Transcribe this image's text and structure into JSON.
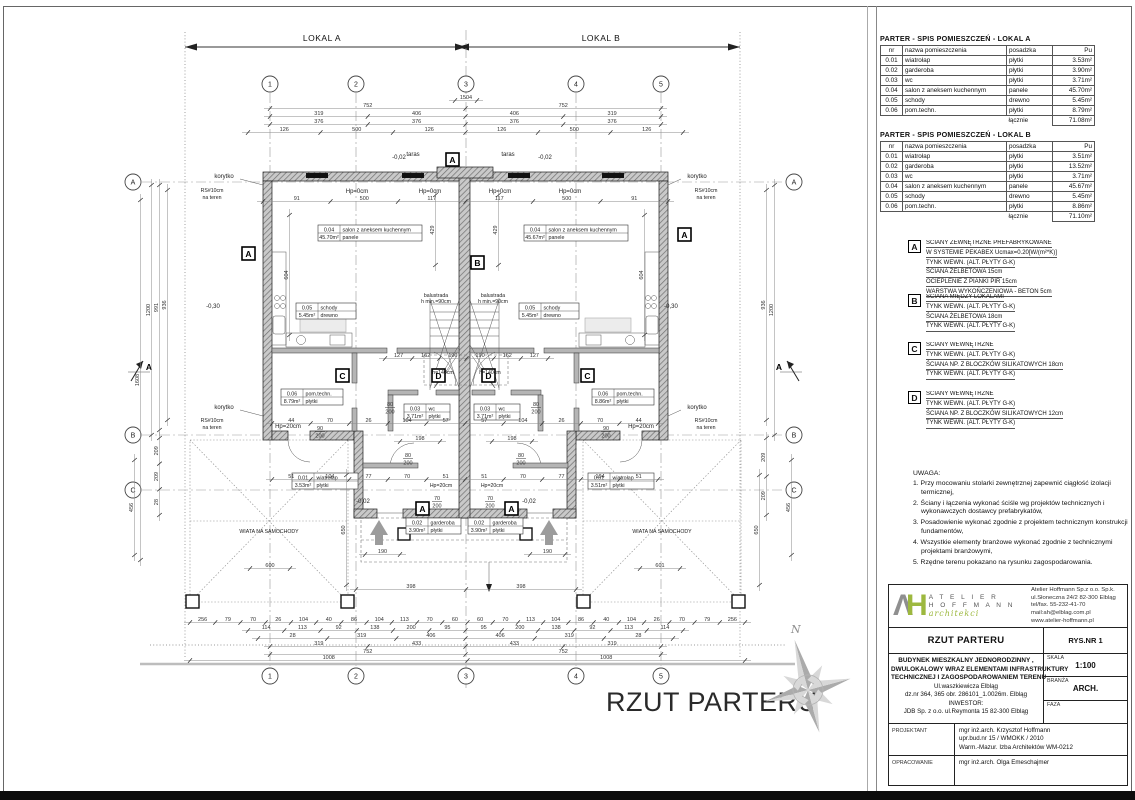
{
  "page": {
    "sheet_title": "RZUT PARTERU"
  },
  "tables": {
    "lokal_a": {
      "title": "PARTER - SPIS POMIESZCZEŃ - LOKAL A",
      "headers": [
        "nr",
        "nazwa pomieszczenia",
        "posadzka",
        "Pu"
      ],
      "rows": [
        [
          "0.01",
          "wiatrołap",
          "płytki",
          "3.53m²"
        ],
        [
          "0.02",
          "garderoba",
          "płytki",
          "3.90m²"
        ],
        [
          "0.03",
          "wc",
          "płytki",
          "3.71m²"
        ],
        [
          "0.04",
          "salon z aneksem kuchennym",
          "panele",
          "45.70m²"
        ],
        [
          "0.05",
          "schody",
          "drewno",
          "5.45m²"
        ],
        [
          "0.06",
          "pom.techn.",
          "płytki",
          "8.79m²"
        ]
      ],
      "total_label": "łącznie",
      "total_value": "71.08m²"
    },
    "lokal_b": {
      "title": "PARTER - SPIS POMIESZCZEŃ - LOKAL B",
      "headers": [
        "nr",
        "nazwa pomieszczenia",
        "posadzka",
        "Pu"
      ],
      "rows": [
        [
          "0.01",
          "wiatrołap",
          "płytki",
          "3.51m²"
        ],
        [
          "0.02",
          "garderoba",
          "płytki",
          "13.52m²"
        ],
        [
          "0.03",
          "wc",
          "płytki",
          "3.71m²"
        ],
        [
          "0.04",
          "salon z aneksem kuchennym",
          "panele",
          "45.67m²"
        ],
        [
          "0.05",
          "schody",
          "drewno",
          "5.45m²"
        ],
        [
          "0.06",
          "pom.techn.",
          "płytki",
          "8.86m²"
        ]
      ],
      "total_label": "łącznie",
      "total_value": "71.10m²"
    }
  },
  "legend": {
    "a": {
      "mark": "A",
      "lines": [
        "ŚCIANY ZEWNĘTRZNE PREFABRYKOWANE",
        "W SYSTEMIE PEKABEX Ucmax=0.20[W/(m²*K)]",
        "TYNK WEWN. (ALT. PŁYTY G-K)",
        "ŚCIANA ŻELBETOWA 15cm",
        "OCIEPLENIE Z PIANKI PIR 15cm",
        "WARSTWA WYKOŃCZENIOWA - BETON 5cm"
      ]
    },
    "b": {
      "mark": "B",
      "lines": [
        "ŚCIANA MIĘDZY LOKALAMI",
        "TYNK WEWN. (ALT. PŁYTY G-K)",
        "ŚCIANA ŻELBETOWA 18cm",
        "TYNK WEWN. (ALT. PŁYTY G-K)"
      ]
    },
    "c": {
      "mark": "C",
      "lines": [
        "ŚCIANY WEWNĘTRZNE",
        "TYNK WEWN. (ALT. PŁYTY G-K)",
        "ŚCIANA NP. Z BLOCZKÓW SILIKATOWYCH 18cm",
        "TYNK WEWN. (ALT. PŁYTY G-K)"
      ]
    },
    "d": {
      "mark": "D",
      "lines": [
        "ŚCIANY WEWNĘTRZNE",
        "TYNK WEWN. (ALT. PŁYTY G-K)",
        "ŚCIANA NP. Z BLOCZKÓW SILIKATOWYCH 12cm",
        "TYNK WEWN. (ALT. PŁYTY G-K)"
      ]
    }
  },
  "notes": {
    "title": "UWAGA:",
    "items": [
      "1. Przy mocowaniu stolarki zewnętrznej zapewnić ciągłość izolacji termicznej,",
      "2. Ściany i łączenia wykonać ściśle wg projektów technicznych i wykonawczych dostawcy prefabrykatów,",
      "3. Posadowienie wykonać zgodnie z projektem technicznym konstrukcji fundamentów,",
      "4. Wszystkie elementy branżowe wykonać zgodnie z technicznymi projektami branżowymi,",
      "5. Rzędne terenu pokazano na rysunku zagospodarowania."
    ]
  },
  "title_block": {
    "logo": {
      "mark_a": "Λ",
      "mark_h": "H",
      "name_line1": "A T E L I E R",
      "name_line2": "H O F F M A N N",
      "name_script": "architekci",
      "address_lines": [
        "Atelier Hoffmann Sp.z o.o. Sp.k.",
        "ul.Słoneczna 24/2   82-300 Elbląg",
        "tel/fax.  55-232-41-70",
        "mail:ah@elblag.com.pl",
        "www.atelier-hoffmann.pl"
      ]
    },
    "drawing_name": "RZUT PARTERU",
    "rys_nr": "RYS.NR  1",
    "project_lines": [
      "BUDYNEK MIESZKALNY JEDNORODZINNY ,",
      "DWULOKALOWY WRAZ ELEMENTAMI INFRASTRUKTURY",
      "TECHNICZNEJ I ZAGOSPODAROWANIEM TERENU",
      "Ul.waszkiewicza  Elbląg",
      "dz.nr 364, 365 obr. 286101_1.0026m. Elbląg",
      "INWESTOR:",
      "JDB  Sp. z o.o. ul.Reymonta 15 82-300 Elbląg"
    ],
    "skala_label": "SKALA",
    "skala_value": "1:100",
    "branza_label": "BRANŻA",
    "branza_value": "ARCH.",
    "faza_label": "FAZA",
    "projektant_label": "PROJEKTANT",
    "projektant_lines": [
      "mgr inż.arch. Krzysztof Hoffmann",
      "upr.bud.nr 15 / WMOKK / 2010",
      "Warm.-Mazur. Izba Architektów WM-0212"
    ],
    "opracowanie_label": "OPRACOWANIE",
    "opracowanie_value": "mgr inż.arch. Olga Emeschajmer"
  },
  "plan": {
    "span_a": "LOKAL A",
    "span_b": "LOKAL B",
    "grid_cols": [
      "1",
      "2",
      "3",
      "4",
      "5"
    ],
    "grid_rows": [
      "A",
      "B",
      "C"
    ],
    "marks": {
      "a": "A",
      "b": "B",
      "c": "C",
      "d": "D"
    },
    "rooms": {
      "salon_a": {
        "nr": "0.04",
        "name": "salon z aneksem kuchennym",
        "area": "45.70m²",
        "floor": "panele"
      },
      "salon_b": {
        "nr": "0.04",
        "name": "salon z aneksem kuchennym",
        "area": "45.67m²",
        "floor": "panele"
      },
      "schody_a": {
        "nr": "0.05",
        "name": "schody",
        "area": "5.45m²",
        "floor": "drewno"
      },
      "schody_b": {
        "nr": "0.05",
        "name": "schody",
        "area": "5.45m²",
        "floor": "drewno"
      },
      "pom_a": {
        "nr": "0.06",
        "name": "pom.techn.",
        "area": "8.79m²",
        "floor": "płytki"
      },
      "pom_b": {
        "nr": "0.06",
        "name": "pom.techn.",
        "area": "8.86m²",
        "floor": "płytki"
      },
      "wc_a": {
        "nr": "0.03",
        "name": "wc",
        "area": "3.71m²",
        "floor": "płytki"
      },
      "wc_b": {
        "nr": "0.03",
        "name": "wc",
        "area": "3.71m²",
        "floor": "płytki"
      },
      "wiatrolap_a": {
        "nr": "0.01",
        "name": "wiatrołap",
        "area": "3.53m²",
        "floor": "płytki"
      },
      "wiatrolap_b": {
        "nr": "0.01",
        "name": "wiatrołap",
        "area": "3.51m²",
        "floor": "płytki"
      },
      "garderoba_a": {
        "nr": "0.02",
        "name": "garderoba",
        "area": "3.90m²",
        "floor": "płytki"
      },
      "garderoba_b": {
        "nr": "0.02",
        "name": "garderoba",
        "area": "3.90m²",
        "floor": "płytki"
      }
    },
    "ann": {
      "taras": "taras",
      "korytko": "korytko",
      "rs_line1": "RS#10cm",
      "rs_line2": "na teren",
      "hp0": "Hp=0cm",
      "hp20": "Hp=20cm",
      "balustrada_line1": "balustrada",
      "balustrada_line2": "h min.=90cm",
      "h140": "h=140cm",
      "wiata": "WIATA NA SAMOCHODY",
      "lvl_030": "-0,30",
      "lvl_002": "-0,02",
      "section": "A",
      "north": "N"
    },
    "doors": {
      "w70": "70",
      "w80": "80",
      "w90": "90",
      "h": "200"
    },
    "dims": {
      "t1504": [
        "1504"
      ],
      "t752": [
        "752",
        "752"
      ],
      "t319": [
        "319",
        "406",
        "406",
        "319"
      ],
      "t376": [
        "376",
        "376",
        "376",
        "376"
      ],
      "t126": [
        "126",
        "500",
        "126",
        "126",
        "500",
        "126"
      ],
      "t_int": [
        "91",
        "500",
        "117",
        "117",
        "500",
        "91"
      ],
      "b398": [
        "398",
        "398"
      ],
      "b600": [
        "600"
      ],
      "b601": [
        "601"
      ],
      "b190a": [
        "190"
      ],
      "b190b": [
        "190"
      ],
      "ba": [
        "256",
        "79",
        "70",
        "26",
        "104",
        "40",
        "86",
        "104",
        "113",
        "70",
        "60",
        "60",
        "70",
        "113",
        "104",
        "86",
        "40",
        "104",
        "26",
        "70",
        "79",
        "256"
      ],
      "bb": [
        "114",
        "113",
        "92",
        "138",
        "200",
        "95",
        "95",
        "200",
        "138",
        "92",
        "113",
        "114"
      ],
      "bc": [
        "28",
        "319",
        "406",
        "406",
        "319",
        "28"
      ],
      "bd": [
        "319",
        "433",
        "433",
        "319"
      ],
      "be": [
        "752",
        "752"
      ],
      "bf": [
        "1008",
        "1008"
      ],
      "c357": [
        "127",
        "162",
        "190",
        "190",
        "162",
        "127"
      ],
      "c422": [
        "44",
        "70",
        "26",
        "104",
        "57",
        "57",
        "104",
        "26",
        "70",
        "44"
      ],
      "c478": [
        "51",
        "104",
        "77",
        "70",
        "51",
        "51",
        "70",
        "77",
        "104",
        "51"
      ],
      "n198a": [
        "198"
      ],
      "n198b": [
        "198"
      ],
      "lv1608": [
        "1608"
      ],
      "lv1200": [
        "1200"
      ],
      "lv991": [
        "991"
      ],
      "lv936": [
        "936"
      ],
      "lv209": [
        "209",
        "209",
        "28"
      ],
      "lv456": [
        "456"
      ],
      "lv650": [
        "650"
      ],
      "rv936": [
        "936"
      ],
      "rv1200": [
        "1200"
      ],
      "rv209": [
        "209",
        "209"
      ],
      "rv456": [
        "456"
      ],
      "rv650": [
        "650"
      ],
      "v429a": [
        "429"
      ],
      "v429b": [
        "429"
      ],
      "v604a": [
        "604"
      ],
      "v604b": [
        "604"
      ]
    }
  }
}
